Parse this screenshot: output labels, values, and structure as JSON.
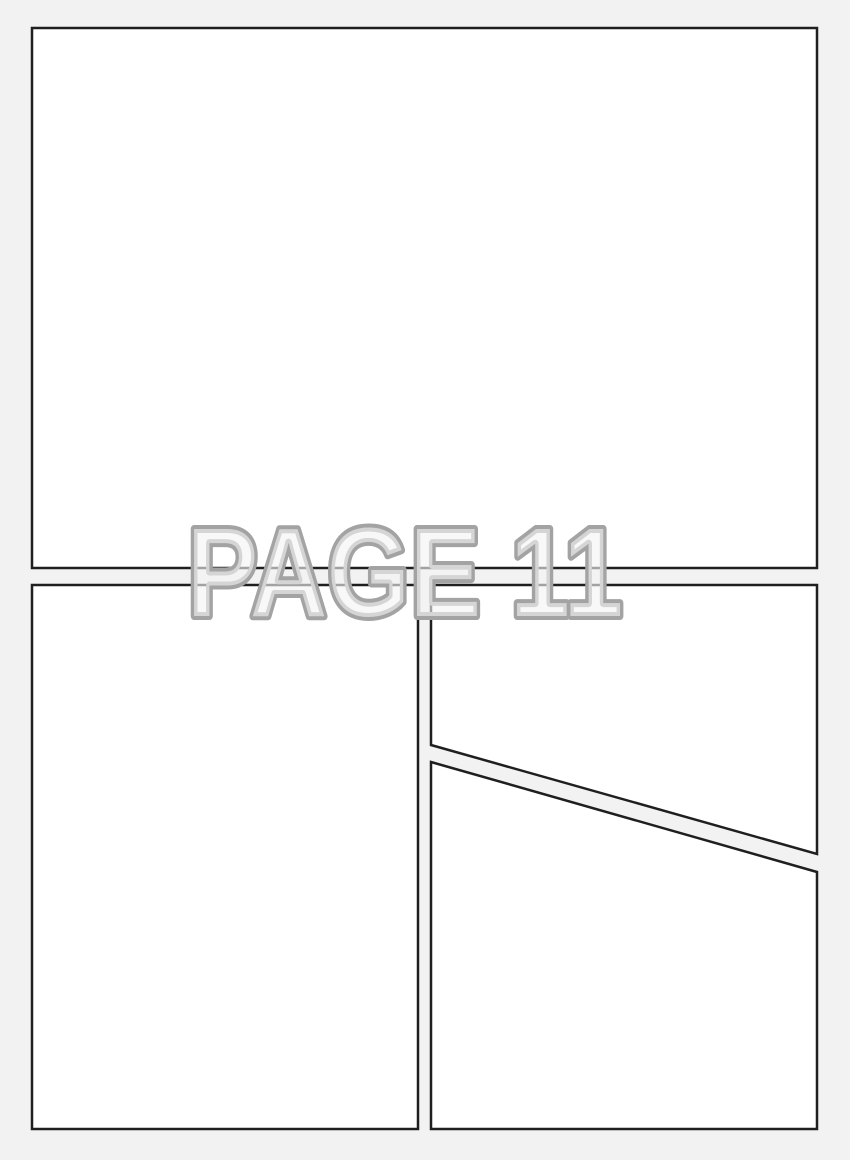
{
  "page": {
    "label": "PAGE 11"
  },
  "colors": {
    "page-bg": "#f2f2f2",
    "panel-fill": "#ffffff",
    "panel-border": "#1f1f1f",
    "label-stroke": "#a3a3a3",
    "label-fill": "#f3f3f3"
  }
}
